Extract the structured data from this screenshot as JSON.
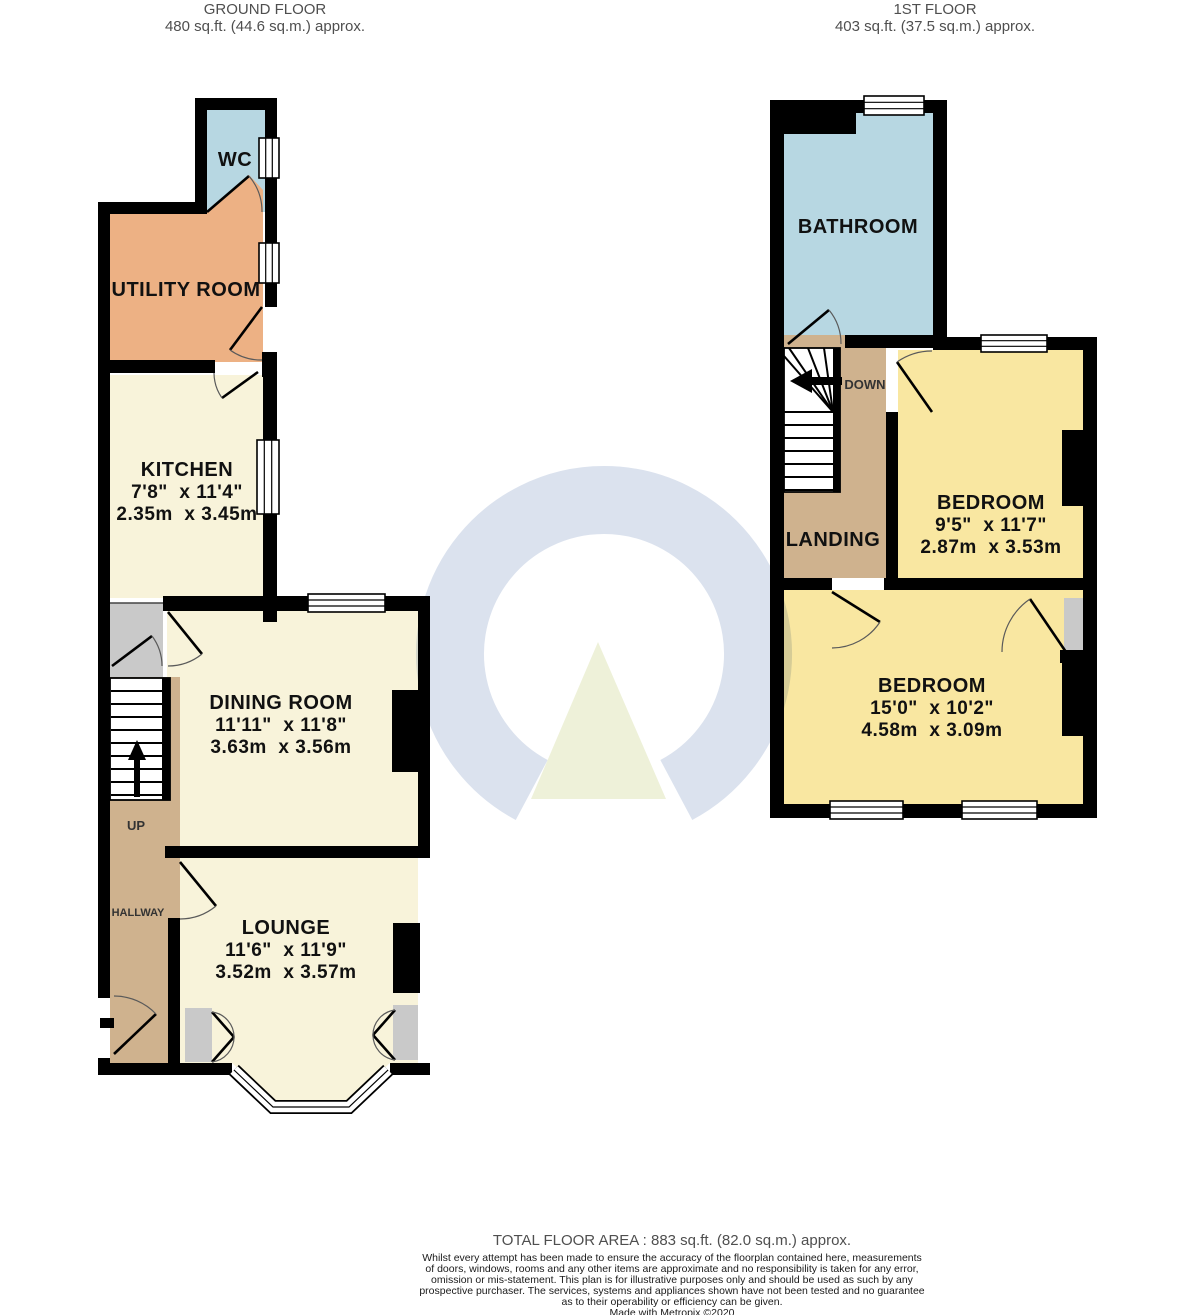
{
  "ground_floor": {
    "header": {
      "title": "GROUND FLOOR",
      "area": "480 sq.ft. (44.6 sq.m.) approx."
    },
    "rooms": {
      "wc": {
        "name": "WC"
      },
      "utility": {
        "name": "UTILITY ROOM"
      },
      "kitchen": {
        "name": "KITCHEN",
        "dims_imperial": "7'8\"  x 11'4\"",
        "dims_metric": "2.35m  x 3.45m"
      },
      "dining": {
        "name": "DINING ROOM",
        "dims_imperial": "11'11\"  x 11'8\"",
        "dims_metric": "3.63m  x 3.56m"
      },
      "lounge": {
        "name": "LOUNGE",
        "dims_imperial": "11'6\"  x 11'9\"",
        "dims_metric": "3.52m  x 3.57m"
      },
      "hallway": {
        "name": "HALLWAY"
      }
    },
    "labels": {
      "up": "UP"
    }
  },
  "first_floor": {
    "header": {
      "title": "1ST FLOOR",
      "area": "403 sq.ft. (37.5 sq.m.) approx."
    },
    "rooms": {
      "bathroom": {
        "name": "BATHROOM"
      },
      "landing": {
        "name": "LANDING"
      },
      "bedroom1": {
        "name": "BEDROOM",
        "dims_imperial": "9'5\"  x 11'7\"",
        "dims_metric": "2.87m  x 3.53m"
      },
      "bedroom2": {
        "name": "BEDROOM",
        "dims_imperial": "15'0\"  x 10'2\"",
        "dims_metric": "4.58m  x 3.09m"
      }
    },
    "labels": {
      "down": "DOWN"
    }
  },
  "footer": {
    "total_area": "TOTAL FLOOR AREA : 883 sq.ft. (82.0 sq.m.) approx.",
    "disclaimer_lines": [
      "Whilst every attempt has been made to ensure the accuracy of the floorplan contained here, measurements",
      "of doors, windows, rooms and any other items are approximate and no responsibility is taken for any error,",
      "omission or mis-statement. This plan is for illustrative purposes only and should be used as such by any",
      "prospective purchaser. The services, systems and appliances shown have not been tested and no guarantee",
      "as to their operability or efficiency can be given."
    ],
    "credit": "Made with Metropix ©2020"
  },
  "colors": {
    "room_cream": "#f8f3da",
    "room_yellow": "#f9e7a1",
    "room_blue": "#b7d7e2",
    "room_orange": "#edb184",
    "room_tan": "#cfb28e",
    "room_gray": "#c9c9c9",
    "wall": "#000000",
    "watermark_ring": "#dbe2ee",
    "watermark_triangle": "#eef1d9"
  }
}
